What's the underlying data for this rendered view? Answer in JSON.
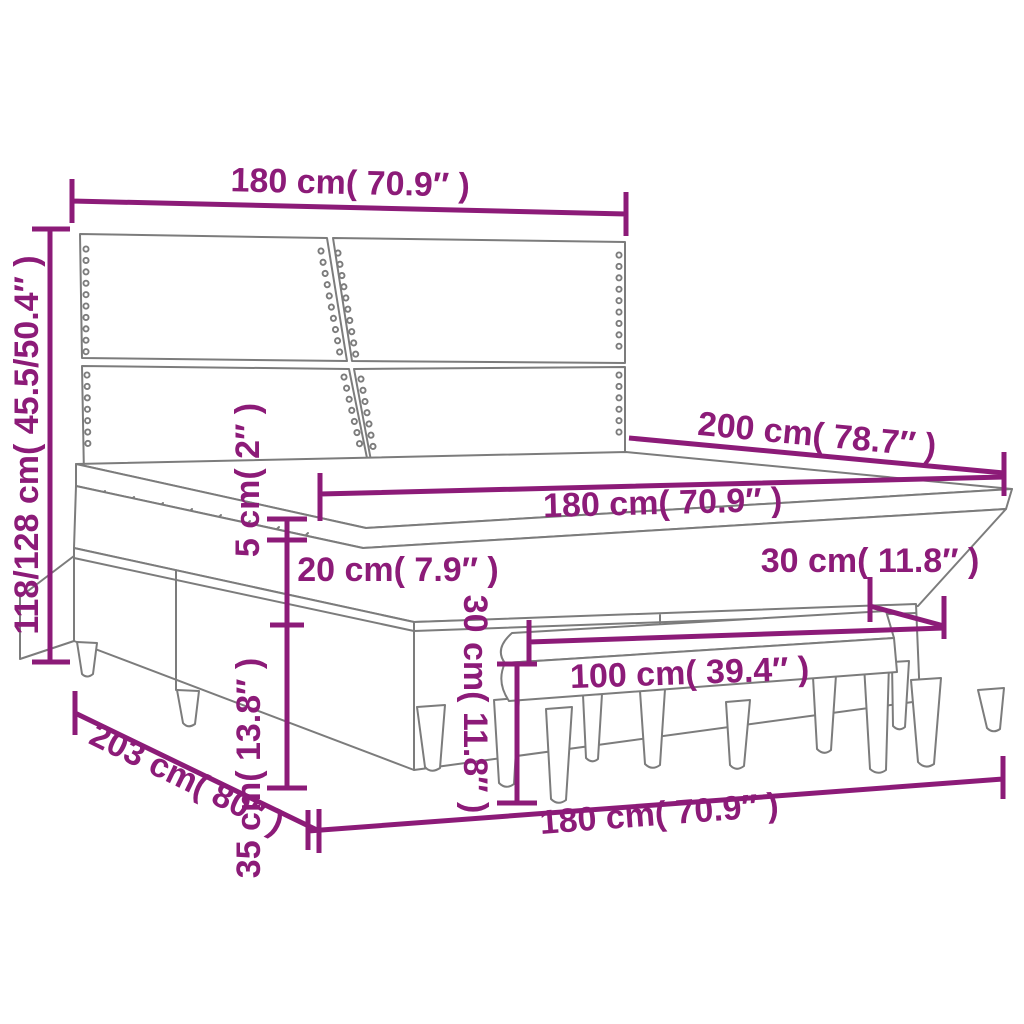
{
  "diagram": {
    "kind": "product-dimension-diagram",
    "product": "box spring bed with headboard, mattress topper and bench",
    "accent_color": "#8C1B78",
    "line_color": "#7C7C7C",
    "background_color": "#FFFFFF",
    "labels": {
      "headboard_width": "180 cm( 70.9″ )",
      "headboard_height": "118/128 cm( 45.5/50.4″ )",
      "bed_length": "200 cm( 78.7″ )",
      "mattress_width": "180 cm( 70.9″ )",
      "topper_thickness": "5 cm( 2″ )",
      "mattress_height": "20 cm( 7.9″ )",
      "base_height": "35 cm( 13.8″ )",
      "bench_depth": "30 cm( 11.8″ )",
      "bench_width": "100 cm( 39.4″ )",
      "bench_height": "30 cm( 11.8″ )",
      "bed_front_width": "180 cm( 70.9″ )",
      "bed_side_length": "203 cm( 80″ )"
    }
  }
}
